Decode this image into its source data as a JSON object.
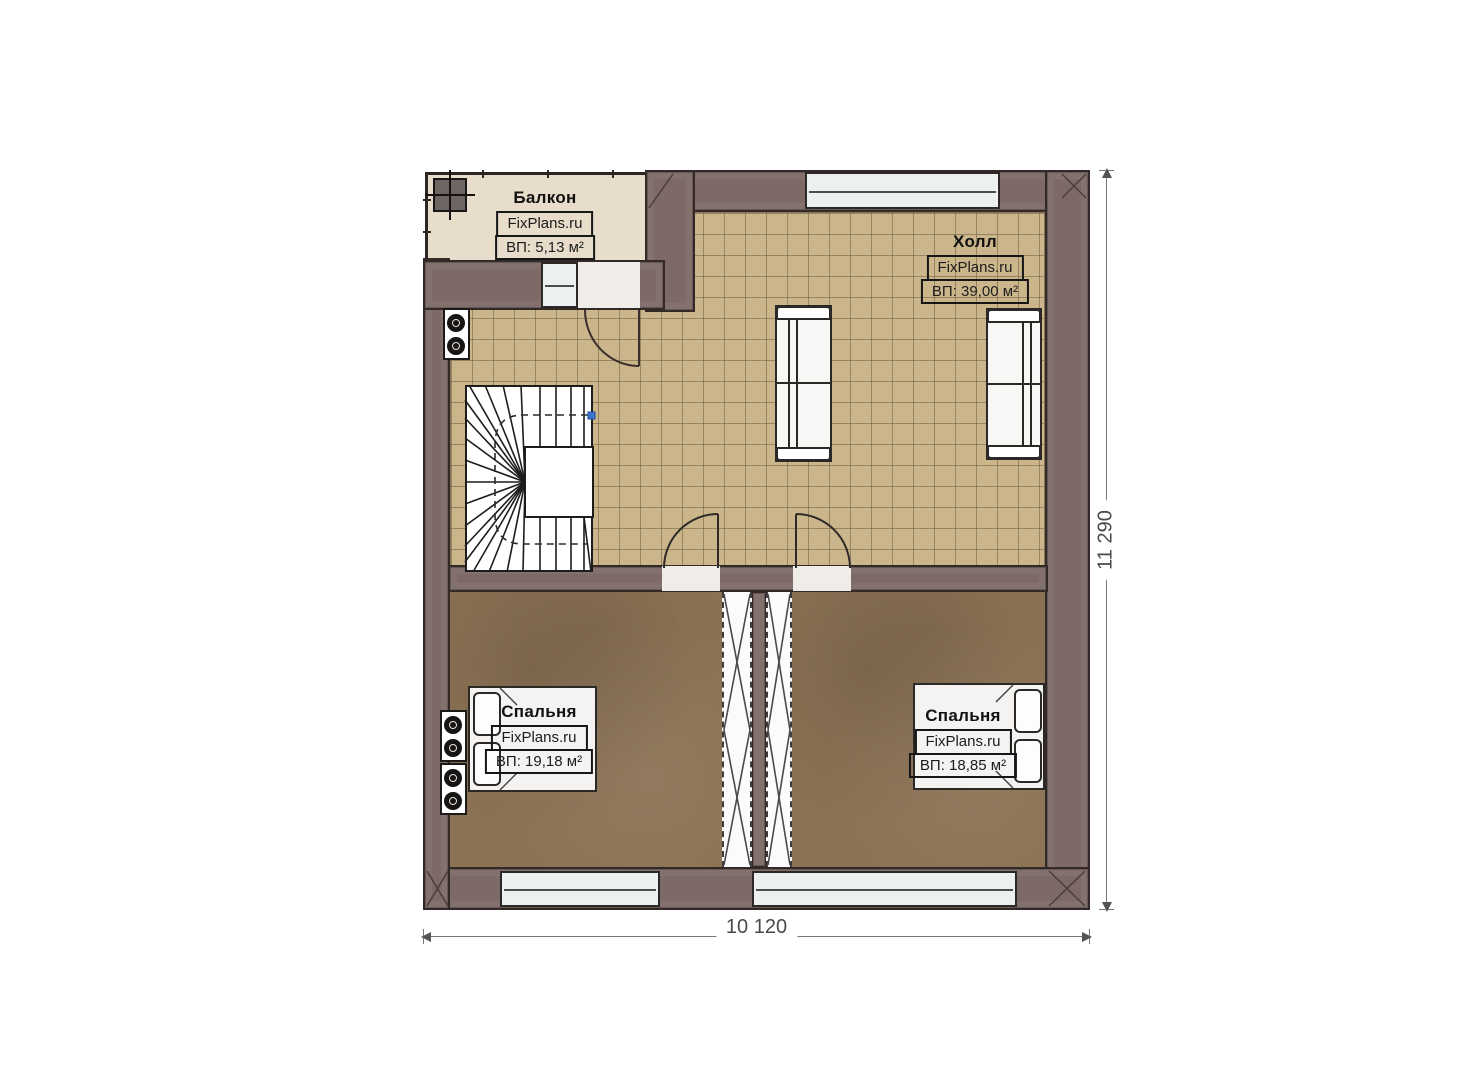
{
  "brand": "FixPlans.ru",
  "rooms": {
    "balcony": {
      "name": "Балкон",
      "area": "ВП: 5,13 м²"
    },
    "hall": {
      "name": "Холл",
      "area": "ВП: 39,00 м²"
    },
    "bedroom_left": {
      "name": "Спальня",
      "area": "ВП: 19,18 м²"
    },
    "bedroom_right": {
      "name": "Спальня",
      "area": "ВП: 18,85 м²"
    }
  },
  "dimensions": {
    "width_mm": "10 120",
    "height_mm": "11 290"
  },
  "colors": {
    "wall": "#7d6a67",
    "hall_floor": "#cbb68c",
    "bedroom_floor": "#8b7254",
    "balcony_floor": "#e7ddca",
    "window": "#edf0f0",
    "stair_marker": "#3f74cc"
  }
}
